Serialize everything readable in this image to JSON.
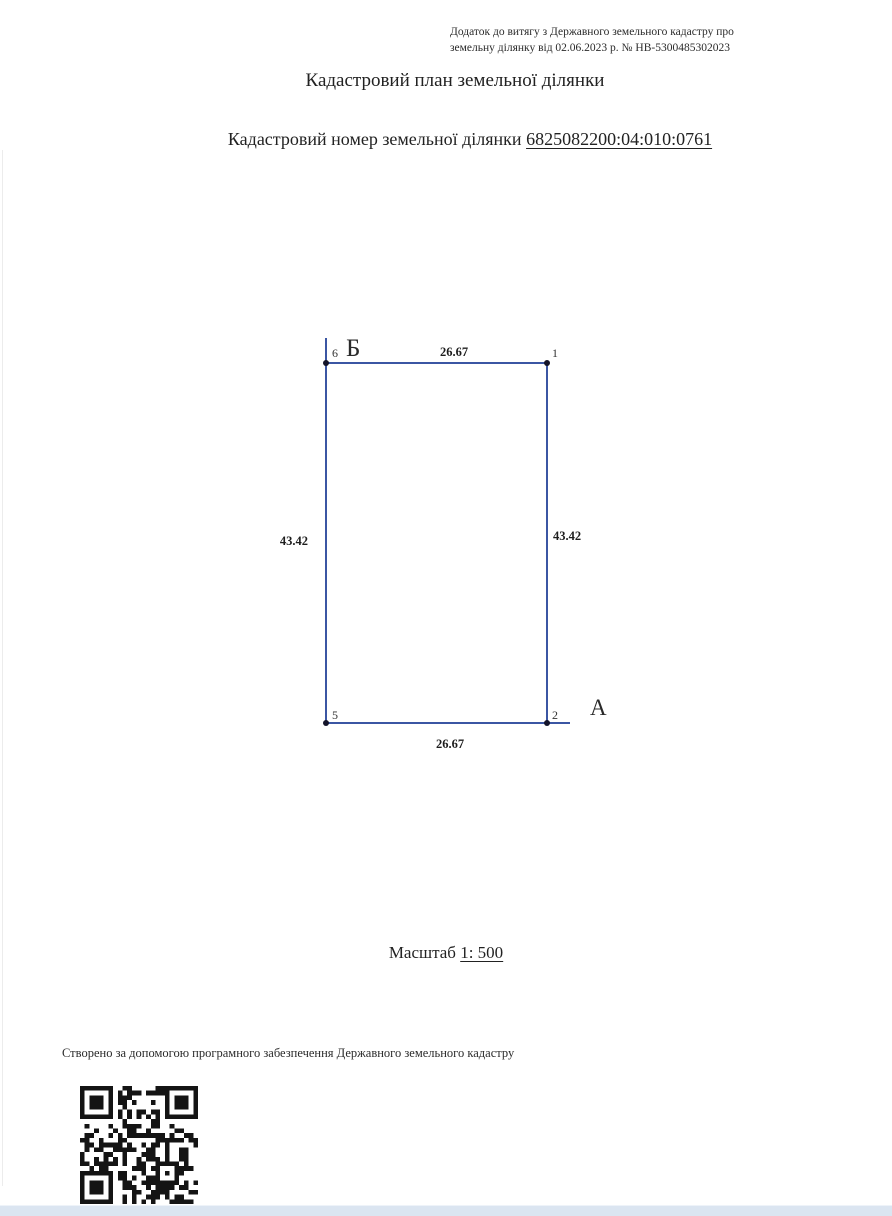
{
  "document": {
    "annex_note": {
      "line1": "Додаток до витягу з Державного земельного кадастру про",
      "line2": "земельну ділянку від 02.06.2023 р. № НВ-5300485302023"
    },
    "title": "Кадастровий план земельної ділянки",
    "cadastral_number_label": "Кадастровий номер земельної ділянки",
    "cadastral_number": "6825082200:04:010:0761",
    "scale_label": "Масштаб",
    "scale_value": "1: 500",
    "footer_note": "Створено за допомогою програмного забезпечення Державного земельного кадастру"
  },
  "parcel_plan": {
    "line_color": "#3b56a3",
    "point_color": "#14142a",
    "vertex_labels": {
      "top_left": "6",
      "top_right": "1",
      "bottom_right": "2",
      "bottom_left": "5"
    },
    "direction_labels": {
      "near_top_left": "Б",
      "near_bottom_right": "А"
    },
    "side_lengths": {
      "top": "26.67",
      "right": "43.42",
      "bottom": "26.67",
      "left": "43.42"
    }
  }
}
